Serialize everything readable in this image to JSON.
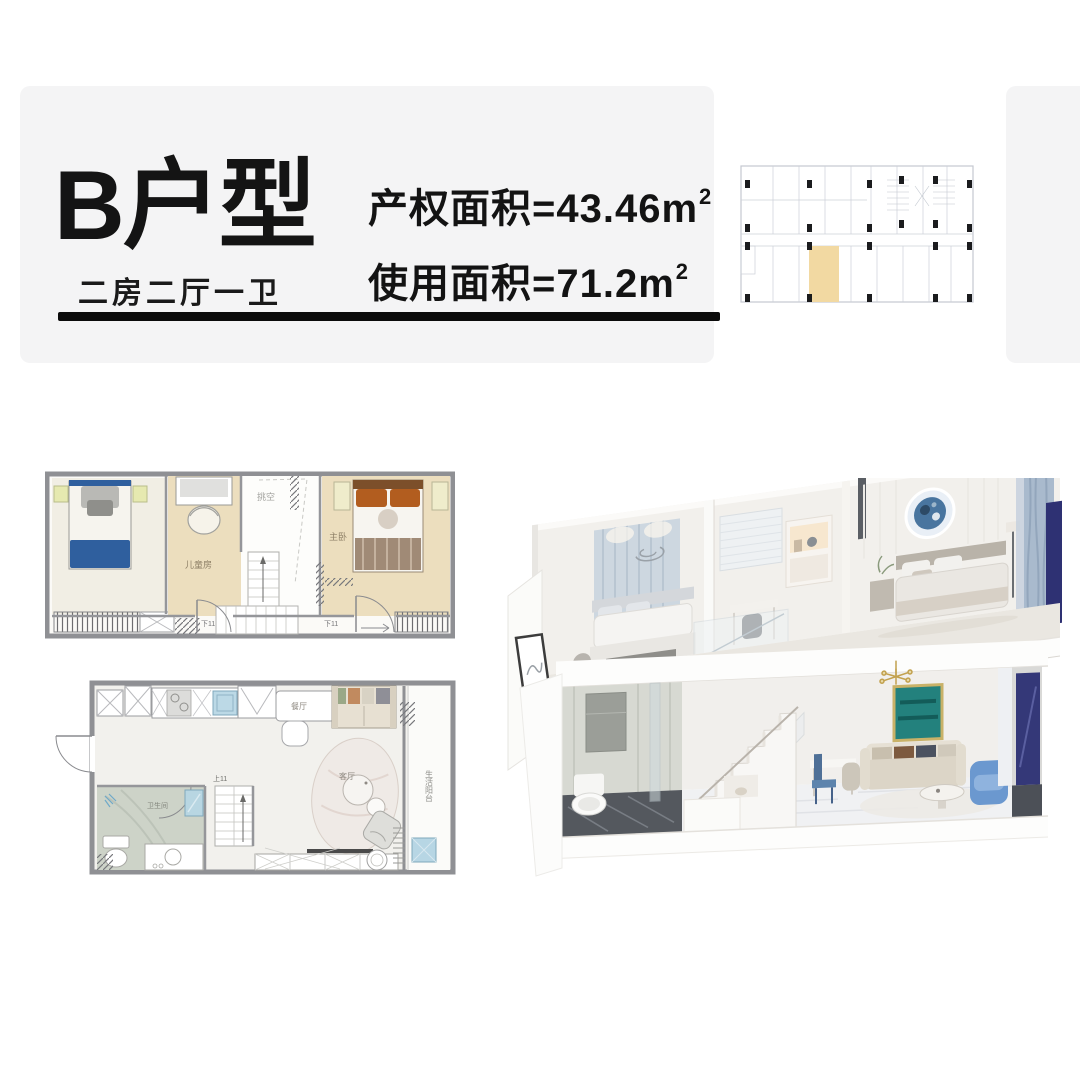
{
  "page": {
    "background": "#ffffff"
  },
  "header": {
    "title": "B户型",
    "subtitle": "二房二厅一卫",
    "area_rows": [
      {
        "label": "产权面积",
        "eq": "=",
        "value": "43.46",
        "unit": "m",
        "sup": "2"
      },
      {
        "label": "使用面积",
        "eq": "=",
        "value": "71.2",
        "unit": "m",
        "sup": "2"
      }
    ]
  },
  "key_plan": {
    "highlight_color": "#f2d9a2"
  },
  "upper_plan": {
    "labels": {
      "void": "挑空",
      "kids_room": "儿童房",
      "master": "主卧",
      "stair_left": "下11",
      "stair_right": "下11"
    }
  },
  "lower_plan": {
    "labels": {
      "dining": "餐厅",
      "bathroom": "卫生间",
      "stair": "上11",
      "living": "客厅",
      "balcony": "生活阳台"
    }
  },
  "colors": {
    "card_bg": "#f4f4f5",
    "ink": "#0d0d0d",
    "wall": "#8f9094",
    "wood_floor": "#ecdebe",
    "unit_highlight": "#f2d9a2",
    "blue_bed": "#2f5f9e"
  }
}
